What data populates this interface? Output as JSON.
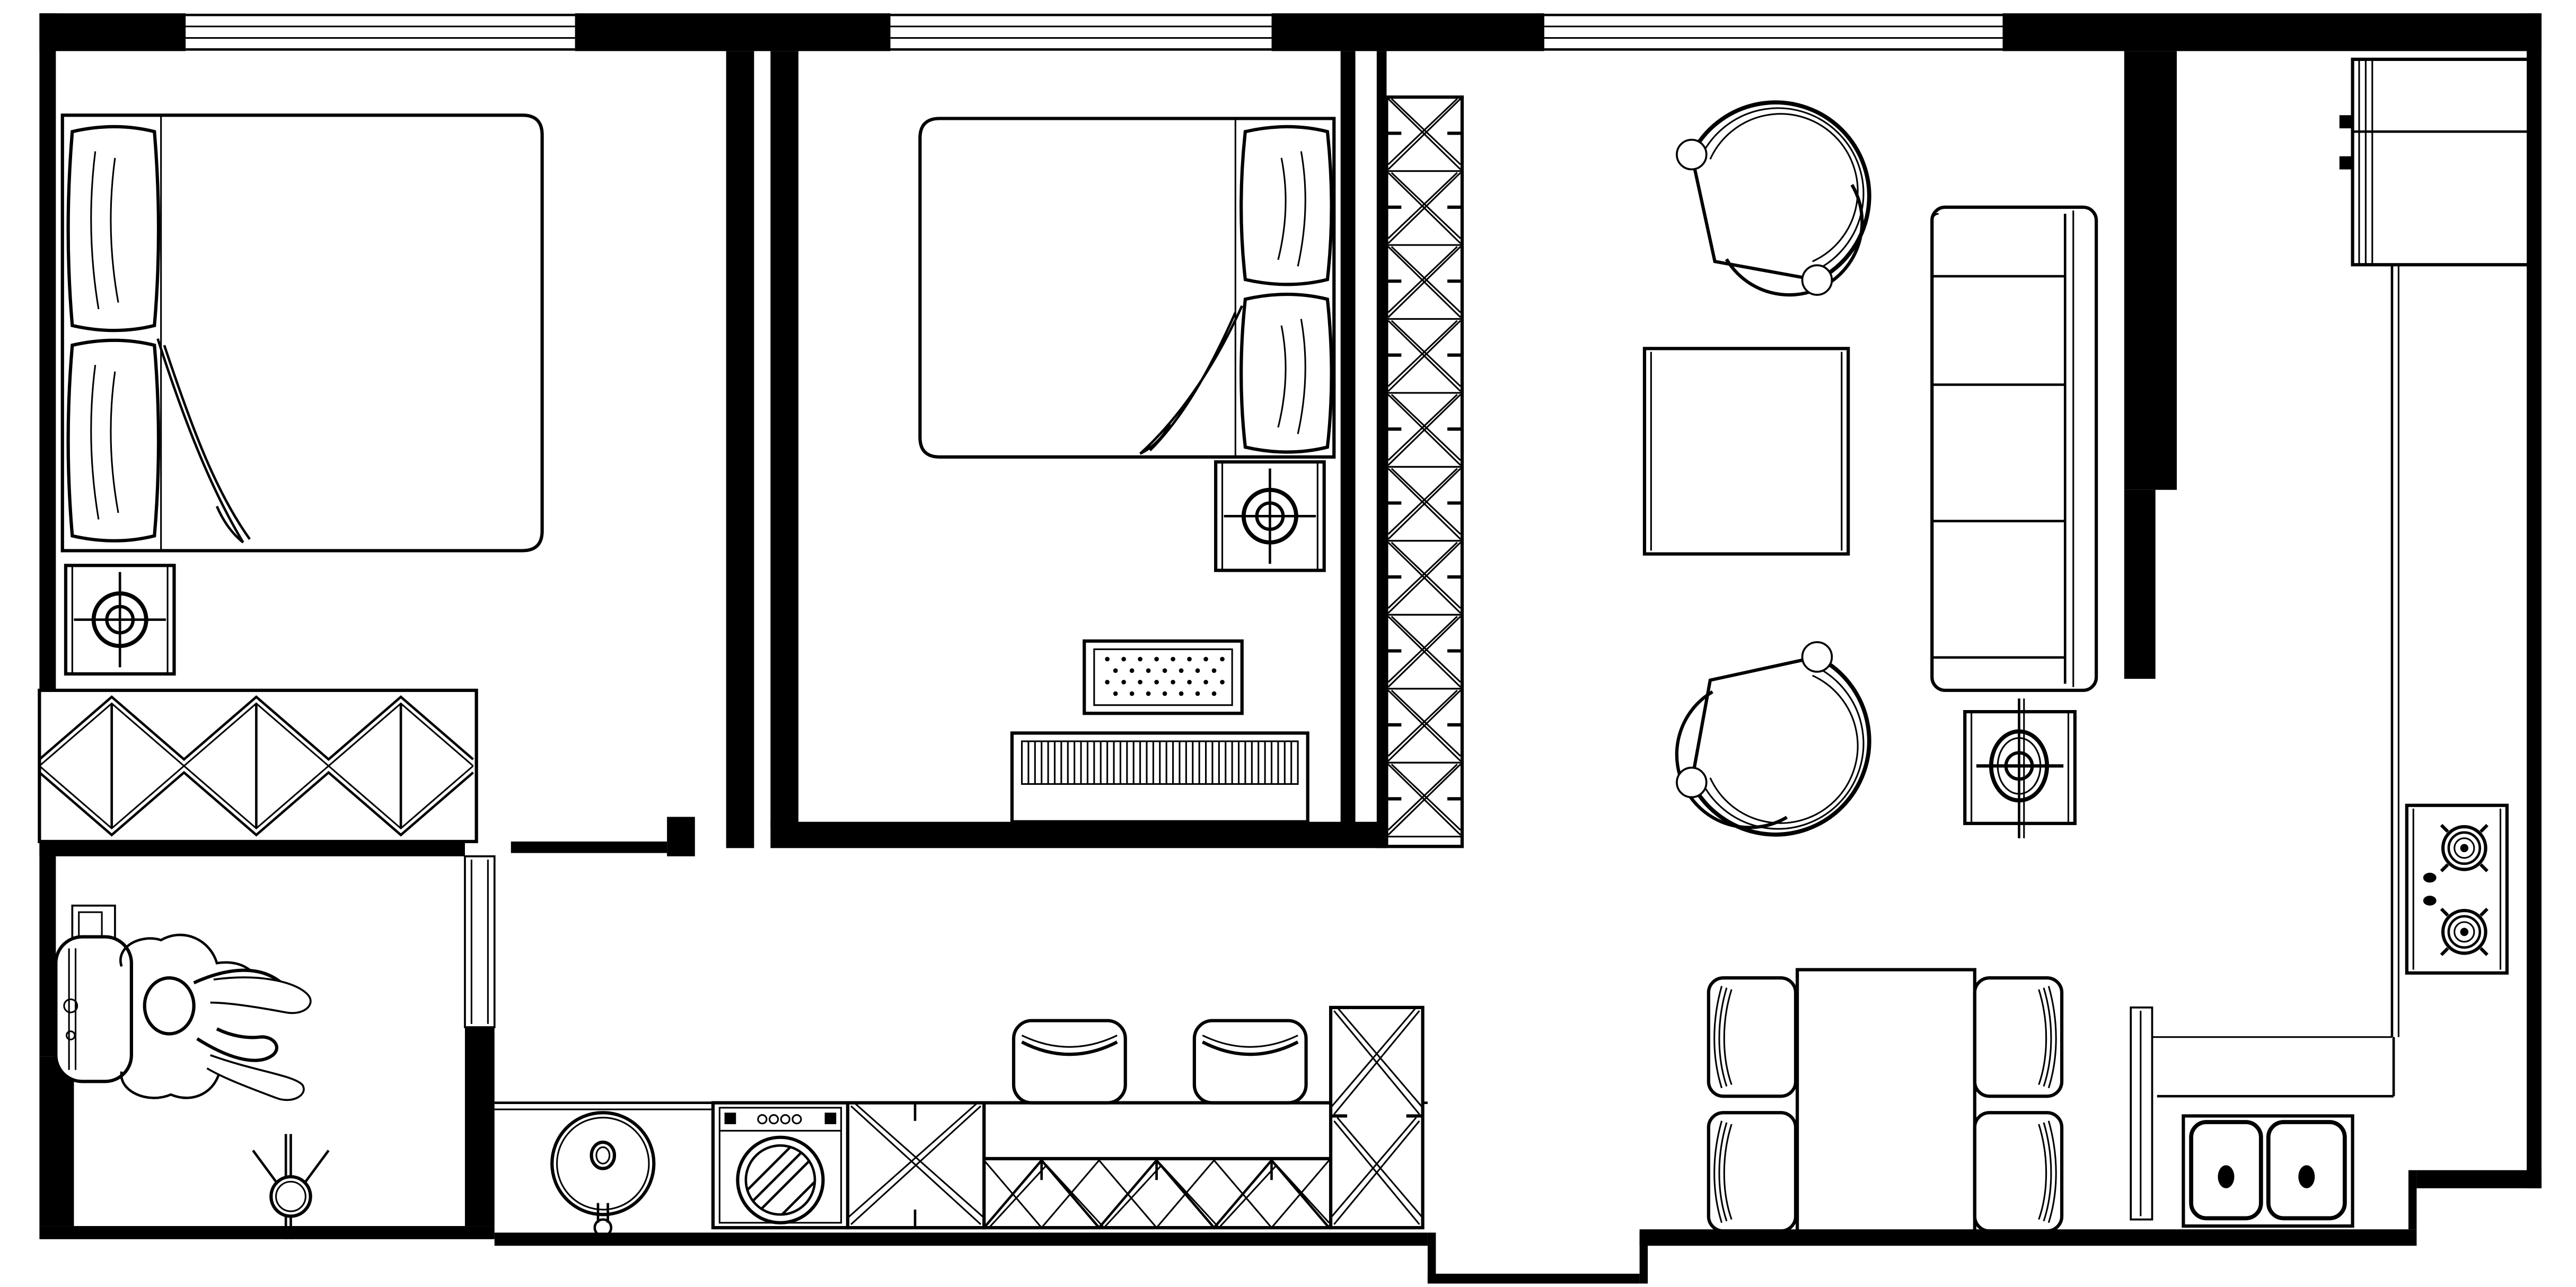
{
  "meta": {
    "type": "architectural-floor-plan",
    "view": "top-down",
    "style": "cad-line-drawing"
  },
  "colors": {
    "background": "#ffffff",
    "line": "#000000"
  },
  "rooms": [
    {
      "id": "bedroom-1",
      "furniture": [
        "double-bed",
        "pillow",
        "pillow",
        "blanket-drape",
        "ceiling-light",
        "wardrobe-x-pattern"
      ]
    },
    {
      "id": "bedroom-2",
      "furniture": [
        "double-bed",
        "pillow",
        "pillow",
        "blanket-drape",
        "ceiling-light",
        "dotted-rug",
        "slatted-cabinet"
      ]
    },
    {
      "id": "bathroom",
      "furniture": [
        "desk-chair",
        "seated-person",
        "wall-box",
        "light-fixture"
      ]
    },
    {
      "id": "hallway",
      "furniture": [
        "tall-cabinet-x-column"
      ]
    },
    {
      "id": "living-room",
      "furniture": [
        "tub-armchair",
        "tub-armchair",
        "coffee-table",
        "three-seat-sofa",
        "ceiling-light"
      ]
    },
    {
      "id": "kitchen",
      "furniture": [
        "refrigerator-cabinet",
        "side-counter",
        "gas-cooktop",
        "double-basin-sink",
        "round-sink",
        "washing-machine",
        "x-base-cabinet",
        "bar-counter-lattice",
        "bar-stool",
        "bar-stool",
        "x-tower-cabinet",
        "pantry-panel"
      ]
    },
    {
      "id": "dining-area",
      "furniture": [
        "dining-table",
        "dining-chair",
        "dining-chair",
        "dining-chair",
        "dining-chair"
      ]
    }
  ],
  "counts": {
    "windows": 3,
    "cooktop_burners": 2,
    "cooktop_knobs": 2,
    "sink_basins": 2,
    "bar_stools": 2,
    "dining_chairs": 4,
    "sofa_seat_sections": 3,
    "tall_cabinet_x_cells": 10,
    "wardrobe_sections": 3
  }
}
